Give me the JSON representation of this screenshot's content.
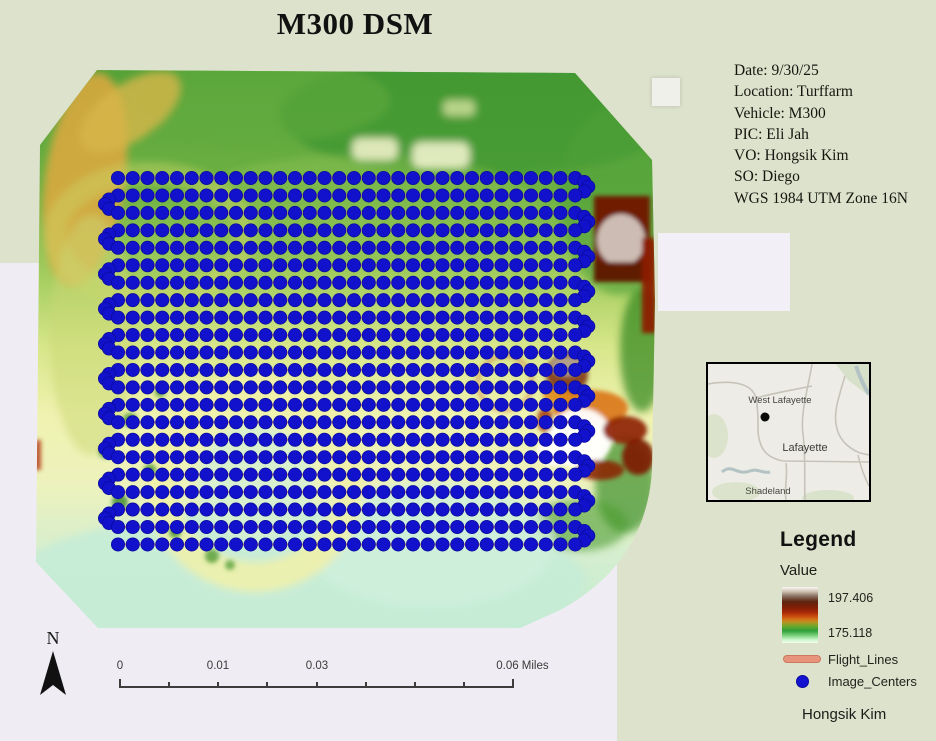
{
  "title": "M300 DSM",
  "metadata_panel": {
    "lines": [
      "Date: 9/30/25",
      "Location: Turffarm",
      "Vehicle: M300",
      "PIC: Eli Jah",
      "VO: Hongsik Kim",
      "SO: Diego",
      "WGS 1984 UTM Zone 16N"
    ]
  },
  "map": {
    "image_centers": {
      "rows": 22,
      "cols": 32,
      "start_x": 118,
      "start_y": 178,
      "dx": 14.75,
      "dy": 17.45,
      "radius": 6.6,
      "color": "#1212cd",
      "stroke": "#0b0b9e",
      "pattern": "serpentine"
    },
    "flight_line_color": "#e2886e",
    "palette": {
      "raster_green": "#55a238",
      "raster_yellow_green": "#d9e78c",
      "raster_pale_yellow": "#eff2b0",
      "raster_mint": "#c2ecd4",
      "raster_orange": "#dfa83e",
      "raster_maroon": "#6f1f05",
      "raster_red": "#a82808",
      "background_sage": "#dde2cc",
      "background_lavender": "#efedf3"
    }
  },
  "inset_map": {
    "labels": {
      "west_lafayette": "West Lafayette",
      "lafayette": "Lafayette",
      "shadeland": "Shadeland"
    }
  },
  "legend": {
    "heading": "Legend",
    "value_label": "Value",
    "ramp_max": "197.406",
    "ramp_min": "175.118",
    "flight_lines_label": "Flight_Lines",
    "image_centers_label": "Image_Centers"
  },
  "scale_bar": {
    "labels": [
      "0",
      "0.01",
      "0.03",
      "0.06 Miles"
    ]
  },
  "north_arrow_label": "N",
  "credit": "Hongsik Kim"
}
